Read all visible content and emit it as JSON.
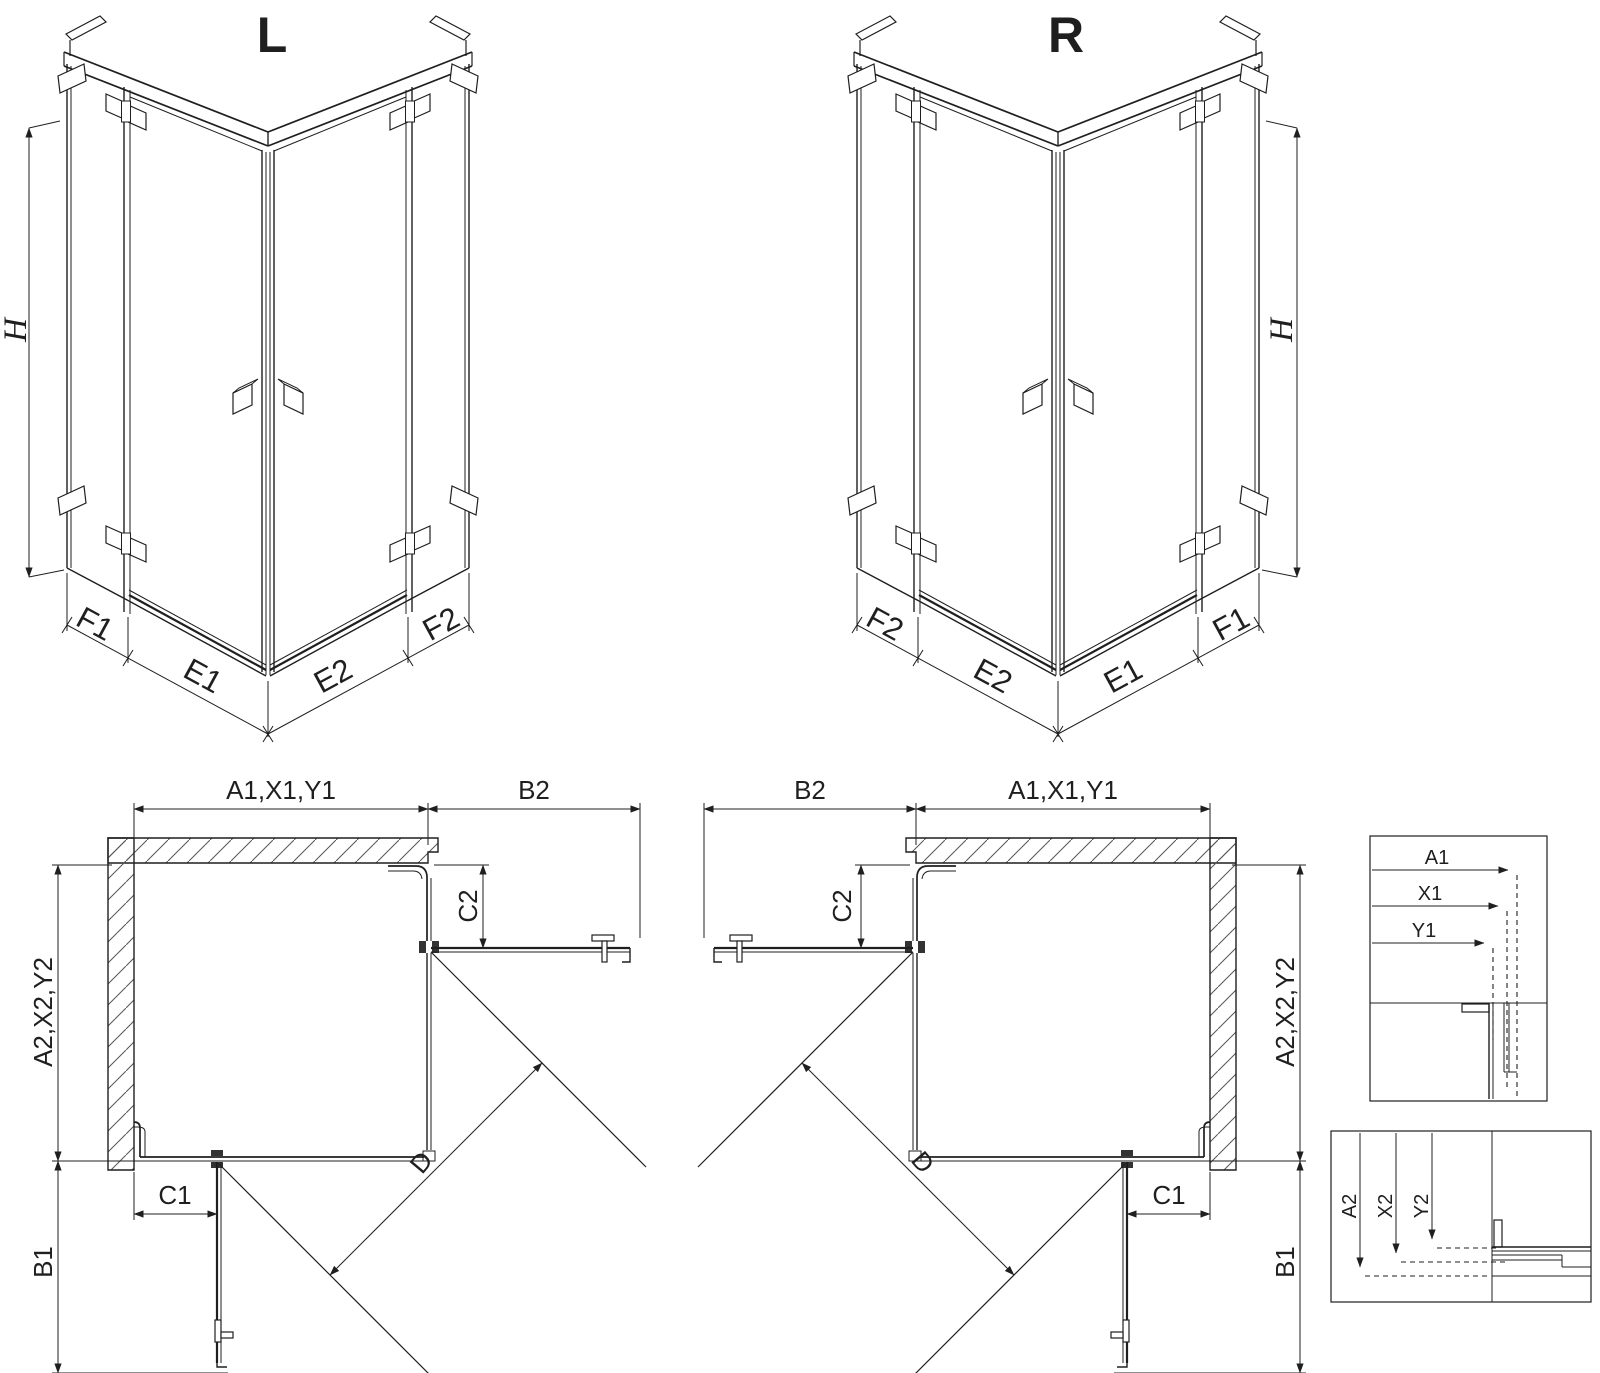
{
  "colors": {
    "ink": "#1f1f1f",
    "hatch": "#555555",
    "background": "#ffffff"
  },
  "iso_views": [
    {
      "label": "L",
      "height": "H",
      "dims": [
        "F1",
        "E1",
        "E2",
        "F2"
      ]
    },
    {
      "label": "R",
      "height": "H",
      "dims": [
        "F2",
        "E2",
        "E1",
        "F1"
      ]
    }
  ],
  "plan_views": [
    {
      "width_top": "A1,X1,Y1",
      "return_top": "B2",
      "depth": "A2,X2,Y2",
      "return_side": "B1",
      "fixed_top": "C2",
      "fixed_bottom": "C1",
      "diagonal": "D"
    },
    {
      "width_top": "A1,X1,Y1",
      "return_top": "B2",
      "depth": "A2,X2,Y2",
      "return_side": "B1",
      "fixed_top": "C2",
      "fixed_bottom": "C1",
      "diagonal": "D"
    }
  ],
  "detail_boxes": [
    {
      "dims": [
        "A1",
        "X1",
        "Y1"
      ]
    },
    {
      "dims": [
        "A2",
        "X2",
        "Y2"
      ]
    }
  ]
}
